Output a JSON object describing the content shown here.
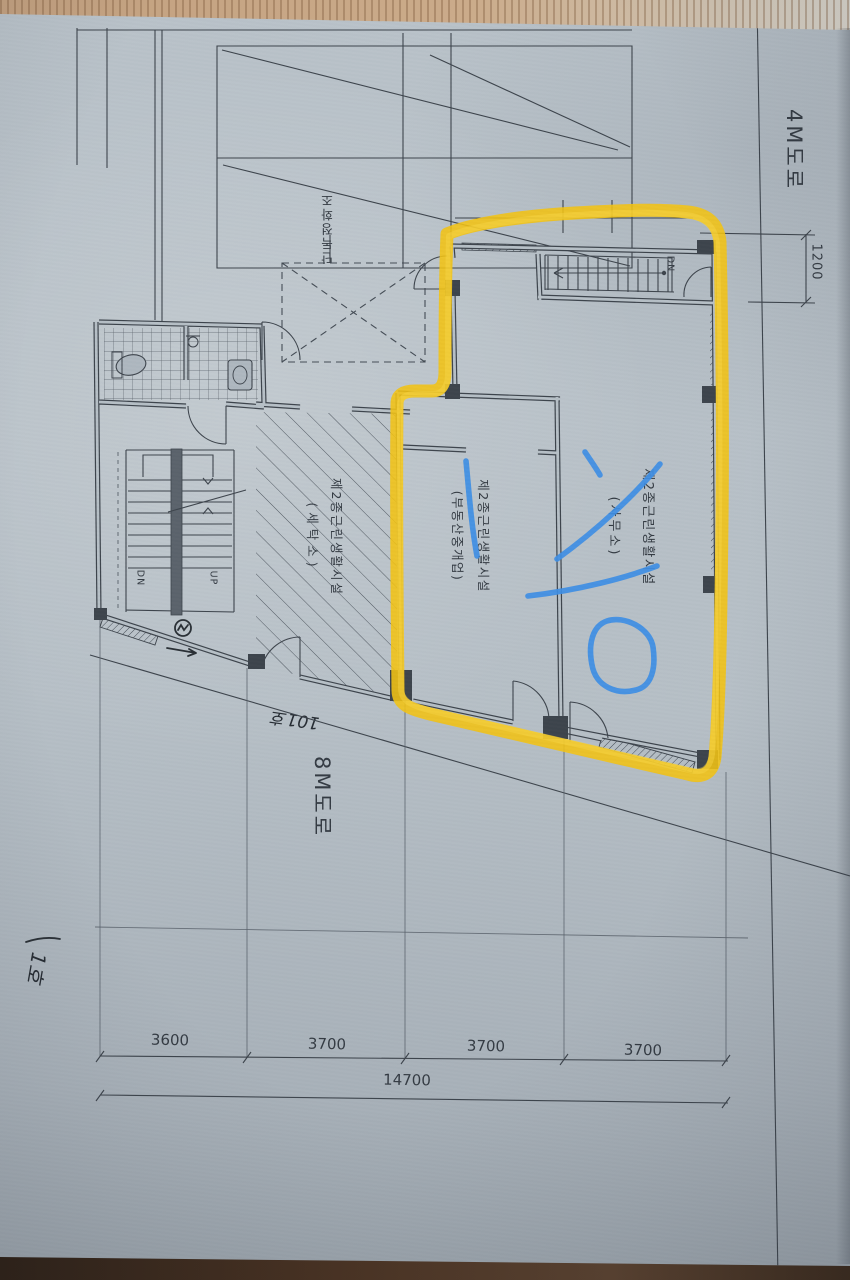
{
  "colors": {
    "paper": "#B6BFC6",
    "ink": "#3D444C",
    "highlighter": "#F3C313",
    "pen_blue": "#3E8EE4",
    "wood_top": "#C2A07F",
    "wood_bottom": "#3A2A1E"
  },
  "plan": {
    "road_label_right": "4M도로",
    "road_label_bottom": "8M도로",
    "septic_tank_label": "단독정화조",
    "rooms": [
      {
        "id": "office",
        "line1": "제2종근린생활시설",
        "line2": "(사무소)"
      },
      {
        "id": "real-estate",
        "line1": "제2종근린생활시설",
        "line2": "(부동산중개업)"
      },
      {
        "id": "laundry",
        "line1": "제2종근린생활시설",
        "line2": "(세탁소)"
      }
    ],
    "stairs": {
      "upper_dn": "DN",
      "left_dn": "DN",
      "left_up": "UP"
    },
    "dimensions": {
      "right_offset": "1200",
      "bottom_segments": [
        "3600",
        "3700",
        "3700",
        "3700"
      ],
      "bottom_total": "14700"
    }
  },
  "handwriting": {
    "unit_note": "101호",
    "corner_note": "1호"
  }
}
